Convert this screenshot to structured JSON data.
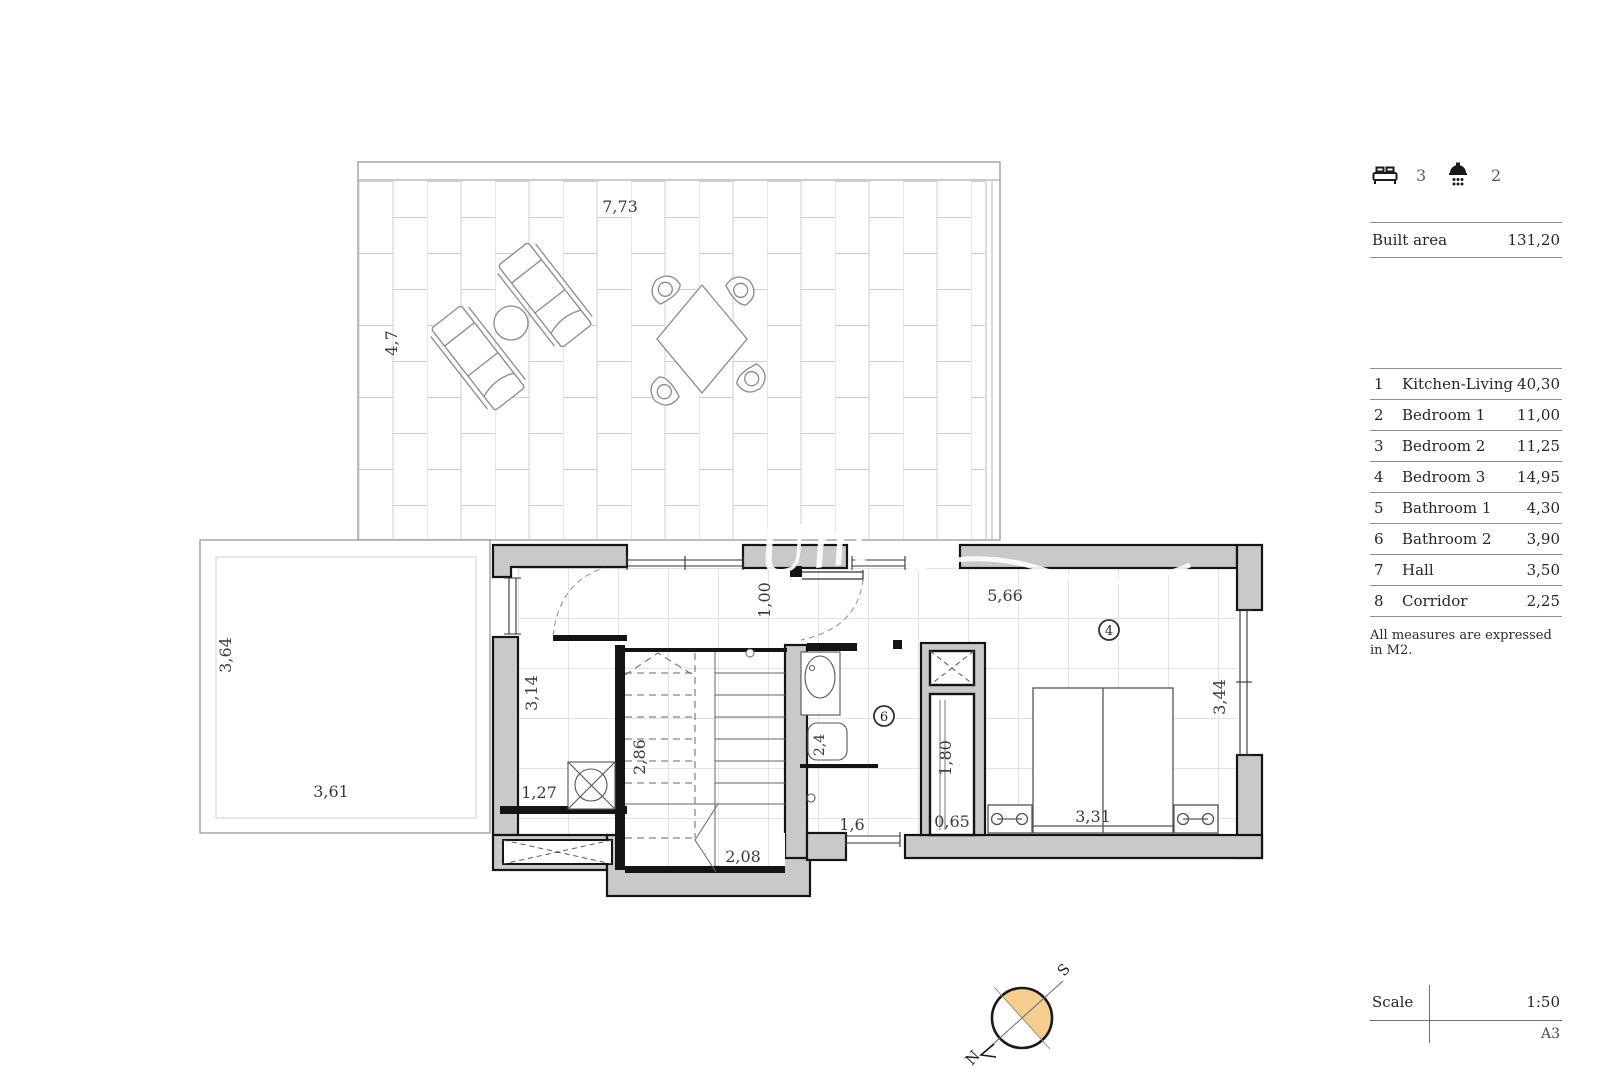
{
  "panel": {
    "beds_count": "3",
    "showers_count": "2",
    "built_area": {
      "label": "Built area",
      "value": "131,20"
    },
    "rooms": [
      {
        "id": "1",
        "name": "Kitchen-Living",
        "area": "40,30"
      },
      {
        "id": "2",
        "name": "Bedroom 1",
        "area": "11,00"
      },
      {
        "id": "3",
        "name": "Bedroom 2",
        "area": "11,25"
      },
      {
        "id": "4",
        "name": "Bedroom 3",
        "area": "14,95"
      },
      {
        "id": "5",
        "name": "Bathroom 1",
        "area": "4,30"
      },
      {
        "id": "6",
        "name": "Bathroom 2",
        "area": "3,90"
      },
      {
        "id": "7",
        "name": "Hall",
        "area": "3,50"
      },
      {
        "id": "8",
        "name": "Corridor",
        "area": "2,25"
      }
    ],
    "note": "All measures are expressed in M2.",
    "scale": {
      "label": "Scale",
      "value": "1:50",
      "sheet": "A3"
    }
  },
  "plan": {
    "dims": {
      "terrace_width": "7,73",
      "terrace_depth": "4,7",
      "annex_depth": "3,64",
      "annex_width": "3,61",
      "utility_depth": "3,14",
      "utility_width": "1,27",
      "stair_depth": "2,86",
      "stair_width": "2,08",
      "entry_door": "1,00",
      "hall_length": "5,66",
      "shower_width": "2,4",
      "bath_window_width": "1,6",
      "closet_depth": "1,80",
      "closet_width": "0,65",
      "bed_width": "3,31",
      "bedroom_depth": "3,44"
    },
    "markers": {
      "bathroom2": "6",
      "bedroom3": "4"
    },
    "watermark": "Um"
  },
  "compass": {
    "north": "N",
    "south": "S"
  },
  "colors": {
    "wall_fill": "#c9c9c9",
    "wall_stroke": "#141414",
    "accent_orange": "#f5cd8e",
    "tile_line": "#cfcfcf",
    "dim_text": "#3a3a3a",
    "rule": "#8f8f8f"
  }
}
